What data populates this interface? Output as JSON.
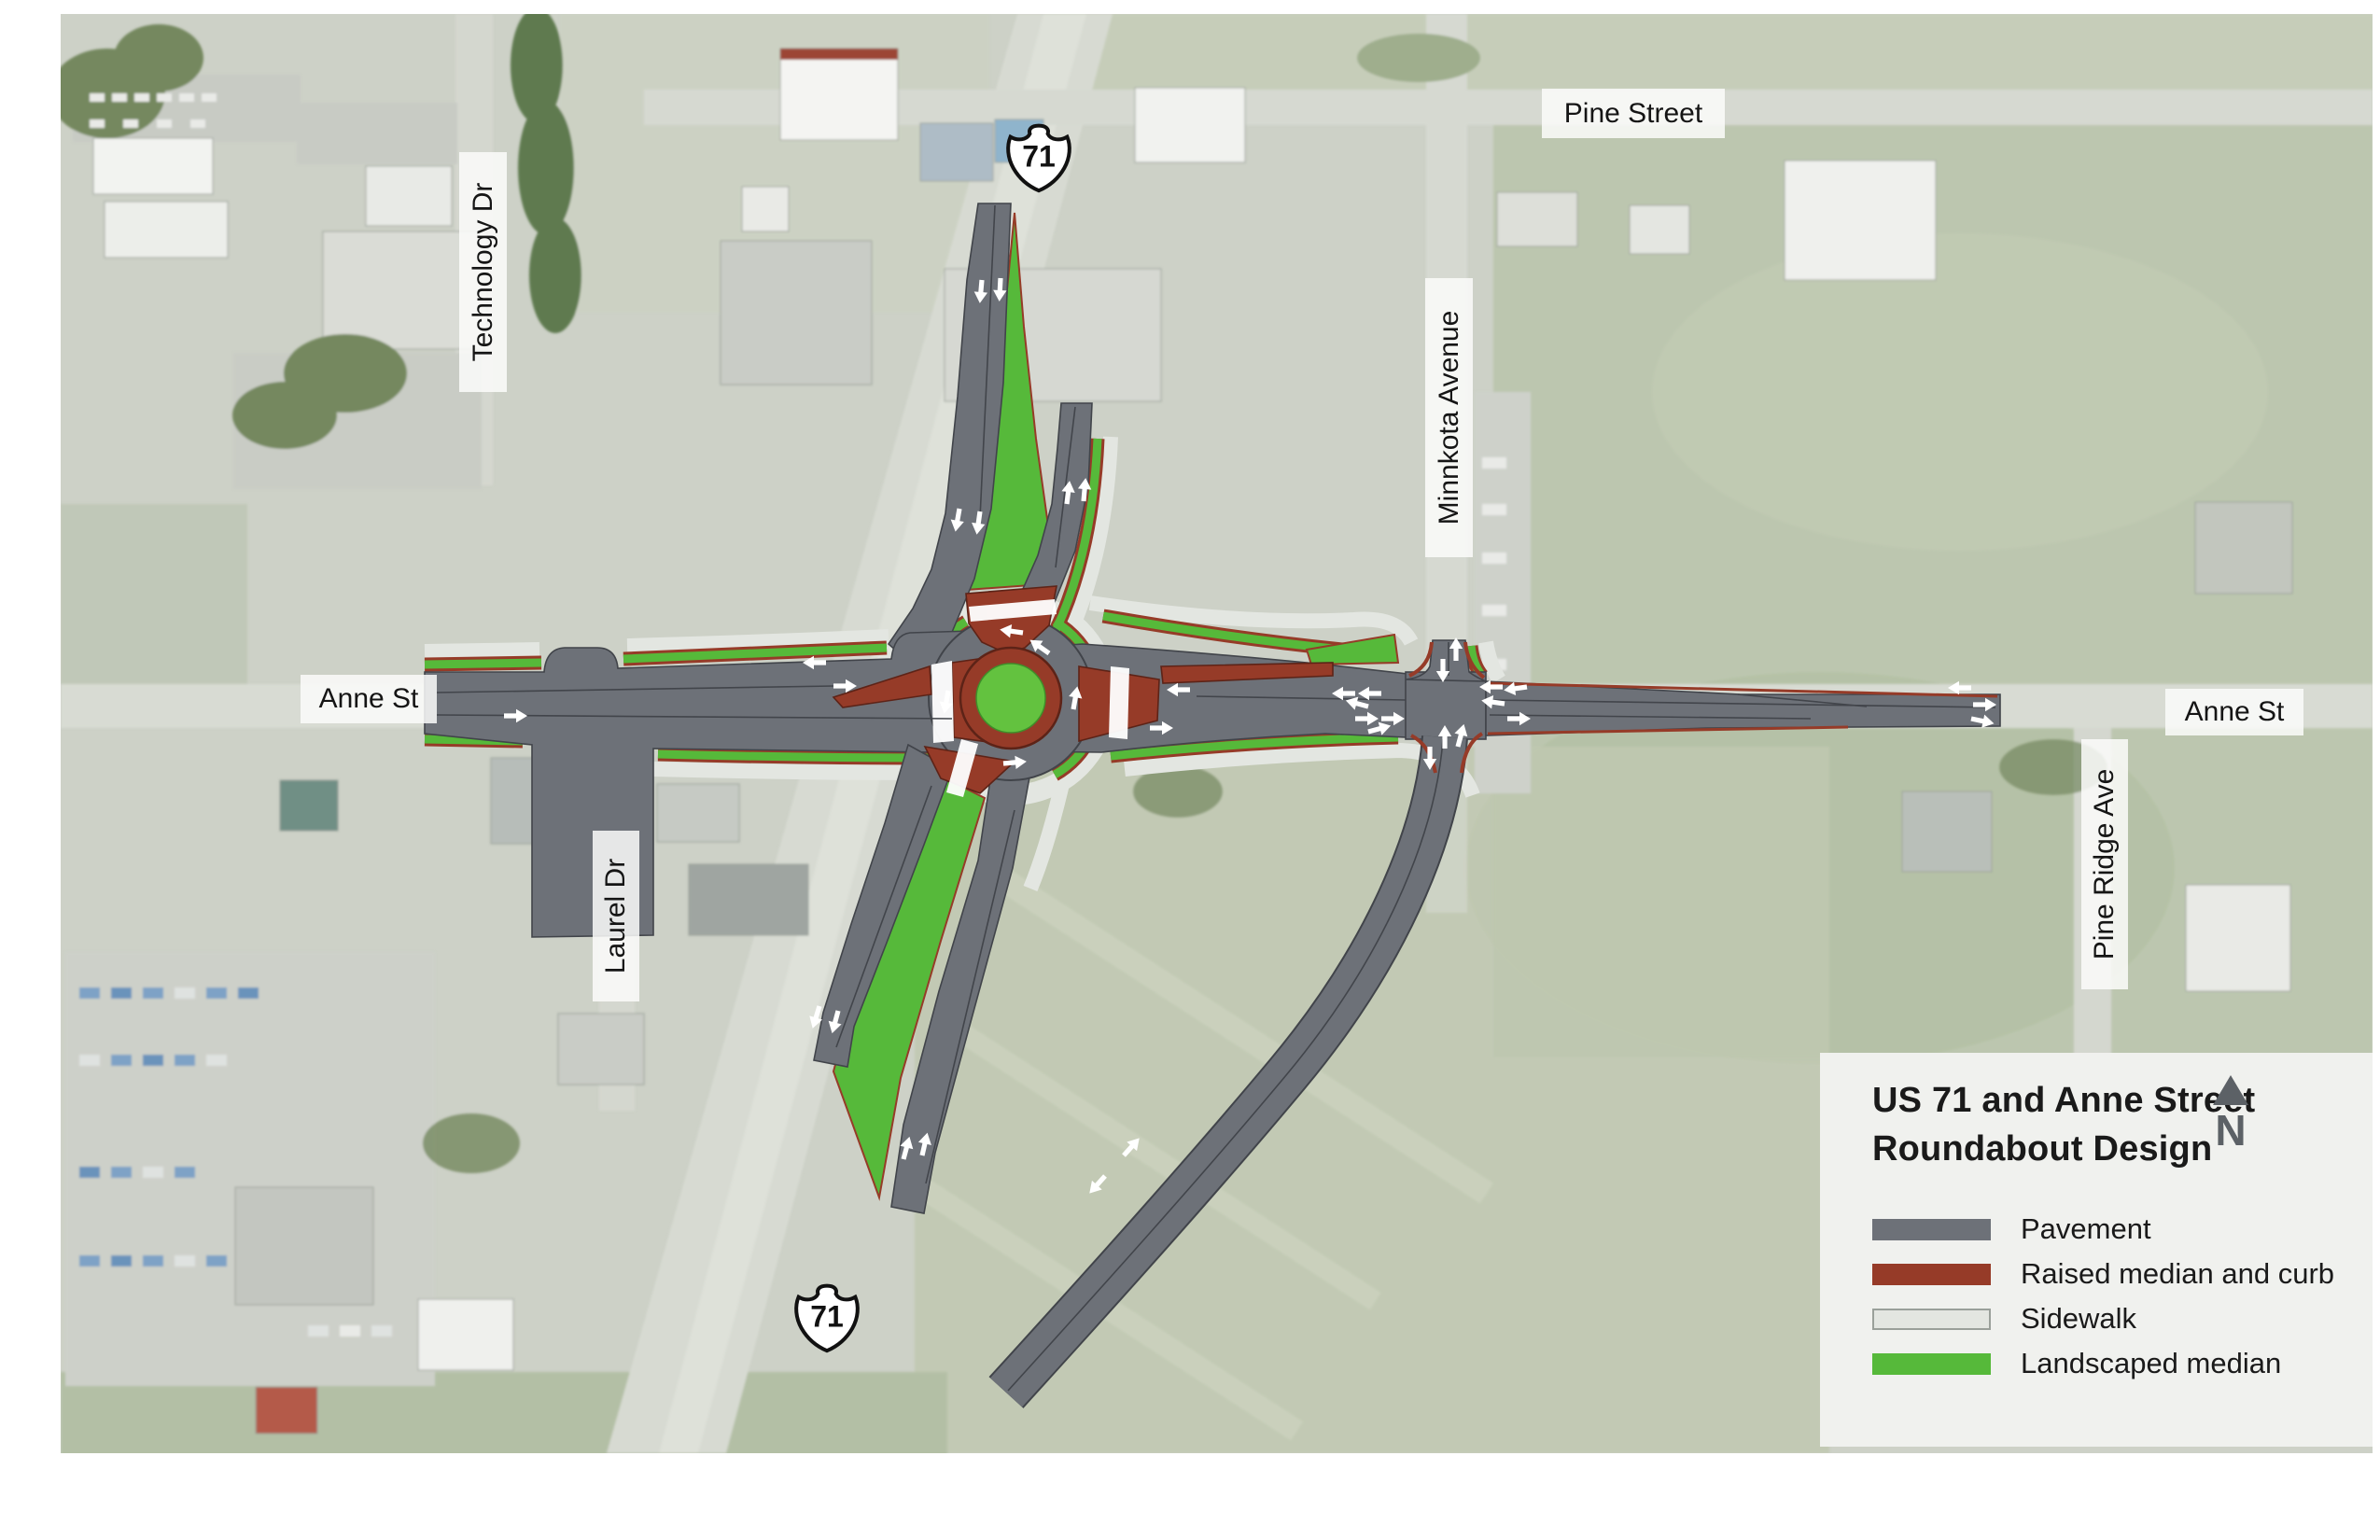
{
  "map": {
    "street_labels": [
      {
        "id": "pine-street",
        "text": "Pine Street"
      },
      {
        "id": "technology-dr",
        "text": "Technology Dr"
      },
      {
        "id": "minnkota-avenue",
        "text": "Minnkota Avenue"
      },
      {
        "id": "anne-st-west",
        "text": "Anne St"
      },
      {
        "id": "anne-st-east",
        "text": "Anne St"
      },
      {
        "id": "laurel-dr",
        "text": "Laurel Dr"
      },
      {
        "id": "pine-ridge-ave",
        "text": "Pine Ridge Ave"
      }
    ],
    "route_shields": [
      {
        "id": "us71-north",
        "text": "71"
      },
      {
        "id": "us71-south",
        "text": "71"
      }
    ]
  },
  "panel": {
    "title_line1": "US 71 and Anne Street",
    "title_line2": "Roundabout Design",
    "north_label": "N",
    "legend": [
      {
        "label": "Pavement",
        "color": "#6d7178"
      },
      {
        "label": "Raised median and curb",
        "color": "#963b28"
      },
      {
        "label": "Sidewalk",
        "color": "#e3e6e1"
      },
      {
        "label": "Landscaped median",
        "color": "#56b93a"
      }
    ]
  }
}
